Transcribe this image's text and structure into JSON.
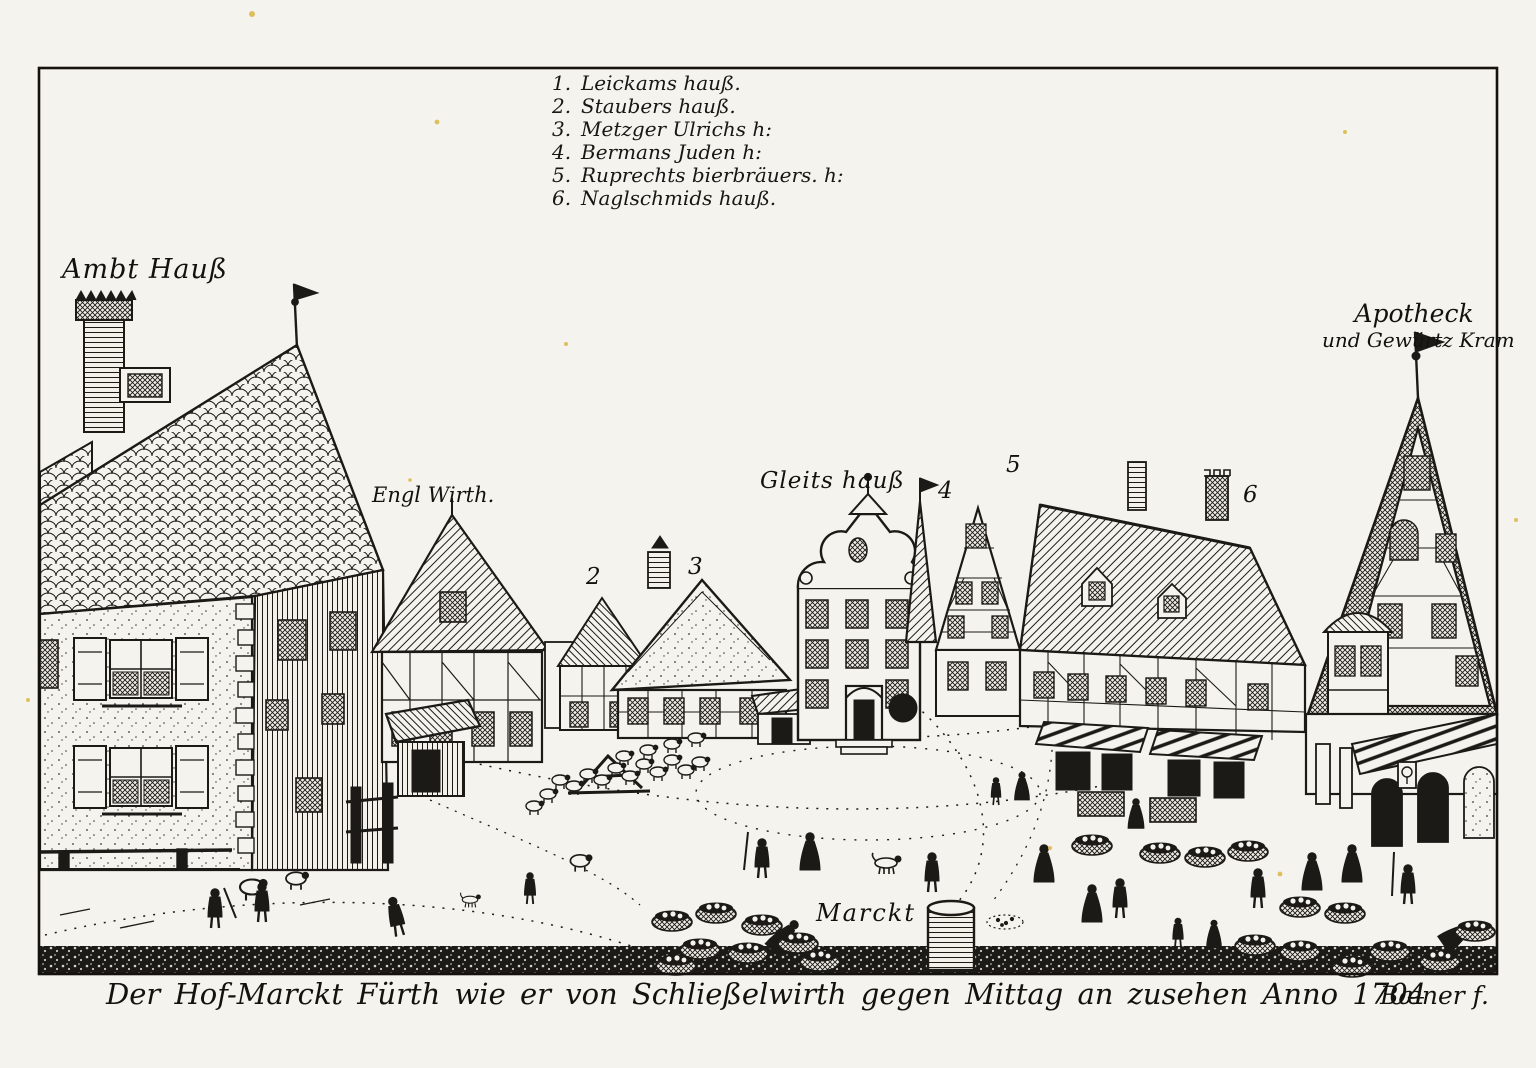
{
  "artwork": {
    "colors": {
      "paper": "#f5f3ed",
      "ink": "#1b1a17",
      "foxing": "#d9b544"
    },
    "legend": {
      "items": [
        {
          "num": "1.",
          "label": "Leickams hauß."
        },
        {
          "num": "2.",
          "label": "Staubers hauß."
        },
        {
          "num": "3.",
          "label": "Metzger Ulrichs h:"
        },
        {
          "num": "4.",
          "label": "Bermans Juden h:"
        },
        {
          "num": "5.",
          "label": "Ruprechts bierbräuers. h:"
        },
        {
          "num": "6.",
          "label": "Naglschmids hauß."
        }
      ]
    },
    "labels": {
      "ambthaus": "Ambt Hauß",
      "englwirth": "Engl Wirth.",
      "gleitshaus": "Gleits hauß",
      "apotheck_line1": "Apotheck",
      "apotheck_line2": "und Gewürtz Kram",
      "marckt": "Marckt"
    },
    "markers": {
      "m2": "2",
      "m3": "3",
      "m4": "4",
      "m5": "5",
      "m6": "6"
    },
    "caption": {
      "text": "Der Hof-Marckt Fürth wie er von Schließelwirth gegen Mittag an zusehen Anno 1704",
      "signature": "Bæner f."
    }
  }
}
